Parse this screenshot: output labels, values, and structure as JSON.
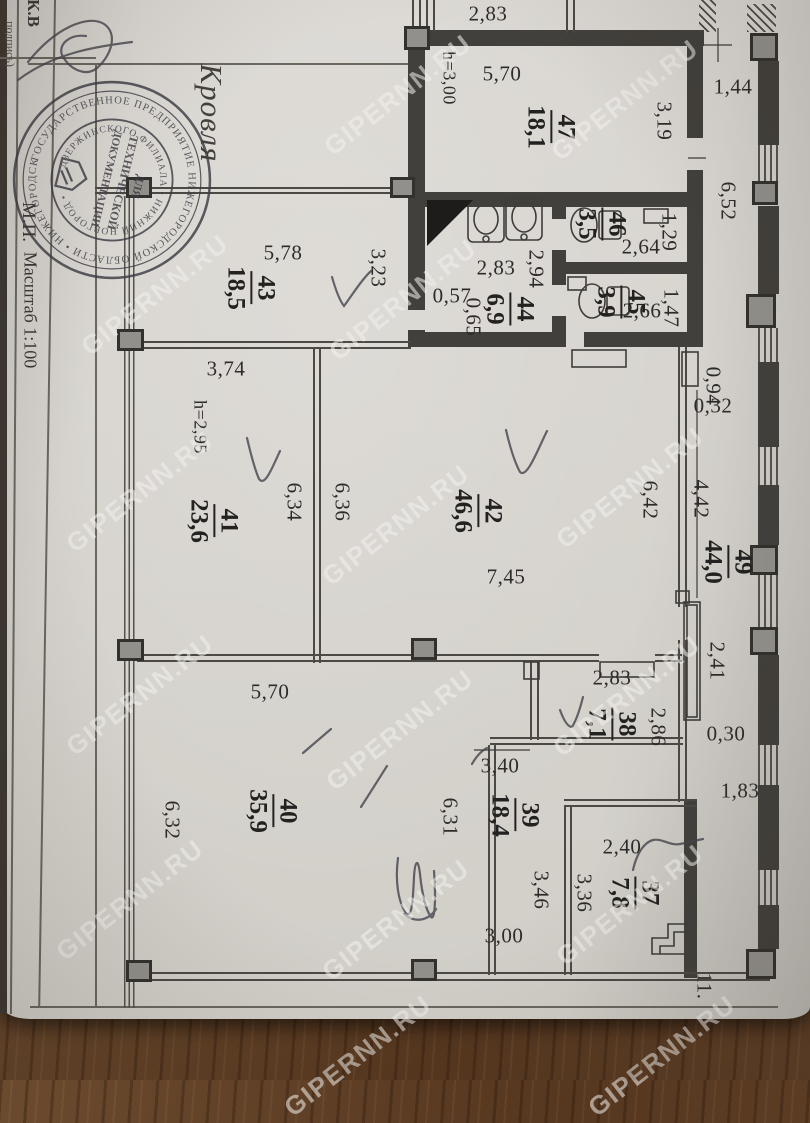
{
  "form": {
    "kv": "К.В",
    "signature_caption": "подпись)",
    "mp": "М.П.",
    "scale": "Масштаб 1:100",
    "roof_label": "Кровля"
  },
  "stamp": {
    "ring_outer": "ГОСУДАРСТВЕННОЕ ПРЕДПРИЯТИЕ НИЖЕГОРОДСКОЙ ОБЛАСТИ • НИЖЕГОРОДСКОЕ ОТДЕЛЕНИЕ • ",
    "ring_inner": "ДЗЕРЖИНСКОГО ФИЛИАЛА • НИЖНИЙ НОВГОРОД • ",
    "center_lines": [
      "ДЛЯ",
      "ТЕХНИЧЕСКОЙ",
      "ДОКУМЕНТАЦИИ"
    ]
  },
  "page": {
    "watermark": "GIPERNN.RU"
  },
  "watermark_positions": [
    [
      398,
      95
    ],
    [
      625,
      100
    ],
    [
      155,
      295
    ],
    [
      403,
      300
    ],
    [
      140,
      492
    ],
    [
      396,
      525
    ],
    [
      630,
      488
    ],
    [
      140,
      695
    ],
    [
      400,
      730
    ],
    [
      627,
      696
    ],
    [
      130,
      900
    ],
    [
      396,
      920
    ],
    [
      630,
      905
    ],
    [
      358,
      1056
    ],
    [
      662,
      1056
    ]
  ],
  "rooms": [
    {
      "n": "47",
      "a": "18,1",
      "x": 550,
      "y": 127
    },
    {
      "n": "46",
      "a": "3,5",
      "x": 601,
      "y": 224
    },
    {
      "n": "45",
      "a": "3,9",
      "x": 620,
      "y": 302
    },
    {
      "n": "44",
      "a": "6,9",
      "x": 509,
      "y": 309
    },
    {
      "n": "43",
      "a": "18,5",
      "x": 250,
      "y": 288
    },
    {
      "n": "41",
      "a": "23,6",
      "x": 213,
      "y": 521
    },
    {
      "n": "42",
      "a": "46,6",
      "x": 477,
      "y": 511
    },
    {
      "n": "49",
      "a": "44,0",
      "x": 727,
      "y": 562
    },
    {
      "n": "40",
      "a": "35,9",
      "x": 272,
      "y": 811
    },
    {
      "n": "38",
      "a": "7,1",
      "x": 611,
      "y": 724
    },
    {
      "n": "39",
      "a": "18,4",
      "x": 514,
      "y": 815
    },
    {
      "n": "37",
      "a": "7,8",
      "x": 634,
      "y": 893
    }
  ],
  "dimensions": [
    {
      "t": "2,83",
      "x": 488,
      "y": 14,
      "o": "h"
    },
    {
      "t": "5,70",
      "x": 502,
      "y": 74,
      "o": "h"
    },
    {
      "t": "1,44",
      "x": 733,
      "y": 87,
      "o": "h"
    },
    {
      "t": "h=3,00",
      "x": 449,
      "y": 78,
      "o": "v",
      "s": 18
    },
    {
      "t": "3,19",
      "x": 664,
      "y": 121,
      "o": "v"
    },
    {
      "t": "6,52",
      "x": 728,
      "y": 201,
      "o": "v"
    },
    {
      "t": "1,29",
      "x": 669,
      "y": 232,
      "o": "v"
    },
    {
      "t": "2,64",
      "x": 641,
      "y": 247,
      "o": "h"
    },
    {
      "t": "2,83",
      "x": 496,
      "y": 268,
      "o": "h"
    },
    {
      "t": "2,94",
      "x": 536,
      "y": 269,
      "o": "v"
    },
    {
      "t": "0,57",
      "x": 452,
      "y": 296,
      "o": "h"
    },
    {
      "t": "0,65",
      "x": 473,
      "y": 317,
      "o": "v"
    },
    {
      "t": "1,47",
      "x": 671,
      "y": 308,
      "o": "v"
    },
    {
      "t": "2,66",
      "x": 642,
      "y": 311,
      "o": "h"
    },
    {
      "t": "5,78",
      "x": 283,
      "y": 253,
      "o": "h"
    },
    {
      "t": "3,23",
      "x": 378,
      "y": 268,
      "o": "v"
    },
    {
      "t": "3,74",
      "x": 226,
      "y": 369,
      "o": "h"
    },
    {
      "t": "h=2,95",
      "x": 200,
      "y": 427,
      "o": "v",
      "s": 18
    },
    {
      "t": "0,94",
      "x": 713,
      "y": 386,
      "o": "v"
    },
    {
      "t": "0,32",
      "x": 713,
      "y": 406,
      "o": "h"
    },
    {
      "t": "6,34",
      "x": 294,
      "y": 502,
      "o": "v"
    },
    {
      "t": "6,36",
      "x": 342,
      "y": 502,
      "o": "v"
    },
    {
      "t": "6,42",
      "x": 650,
      "y": 500,
      "o": "v"
    },
    {
      "t": "4,42",
      "x": 701,
      "y": 499,
      "o": "v"
    },
    {
      "t": "7,45",
      "x": 506,
      "y": 577,
      "o": "h"
    },
    {
      "t": "2,41",
      "x": 717,
      "y": 661,
      "o": "v"
    },
    {
      "t": "5,70",
      "x": 270,
      "y": 692,
      "o": "h"
    },
    {
      "t": "2,83",
      "x": 612,
      "y": 678,
      "o": "h"
    },
    {
      "t": "2,86",
      "x": 658,
      "y": 727,
      "o": "v"
    },
    {
      "t": "0,30",
      "x": 726,
      "y": 734,
      "o": "h"
    },
    {
      "t": "1,83",
      "x": 740,
      "y": 791,
      "o": "h"
    },
    {
      "t": "3,40",
      "x": 500,
      "y": 766,
      "o": "h"
    },
    {
      "t": "2,40",
      "x": 622,
      "y": 847,
      "o": "h"
    },
    {
      "t": "6,32",
      "x": 172,
      "y": 820,
      "o": "v"
    },
    {
      "t": "6,31",
      "x": 450,
      "y": 817,
      "o": "v"
    },
    {
      "t": "3,46",
      "x": 541,
      "y": 890,
      "o": "v"
    },
    {
      "t": "3,36",
      "x": 584,
      "y": 893,
      "o": "v"
    },
    {
      "t": "3,00",
      "x": 504,
      "y": 936,
      "o": "h"
    },
    {
      "t": "11.",
      "x": 704,
      "y": 986,
      "o": "v"
    }
  ],
  "colors": {
    "paper": "#d8d5d0",
    "wall_ink": "#42403c",
    "wood": "#5d3f27",
    "pen_ink": "#45444c",
    "watermark_white": "#f3f1ed"
  }
}
